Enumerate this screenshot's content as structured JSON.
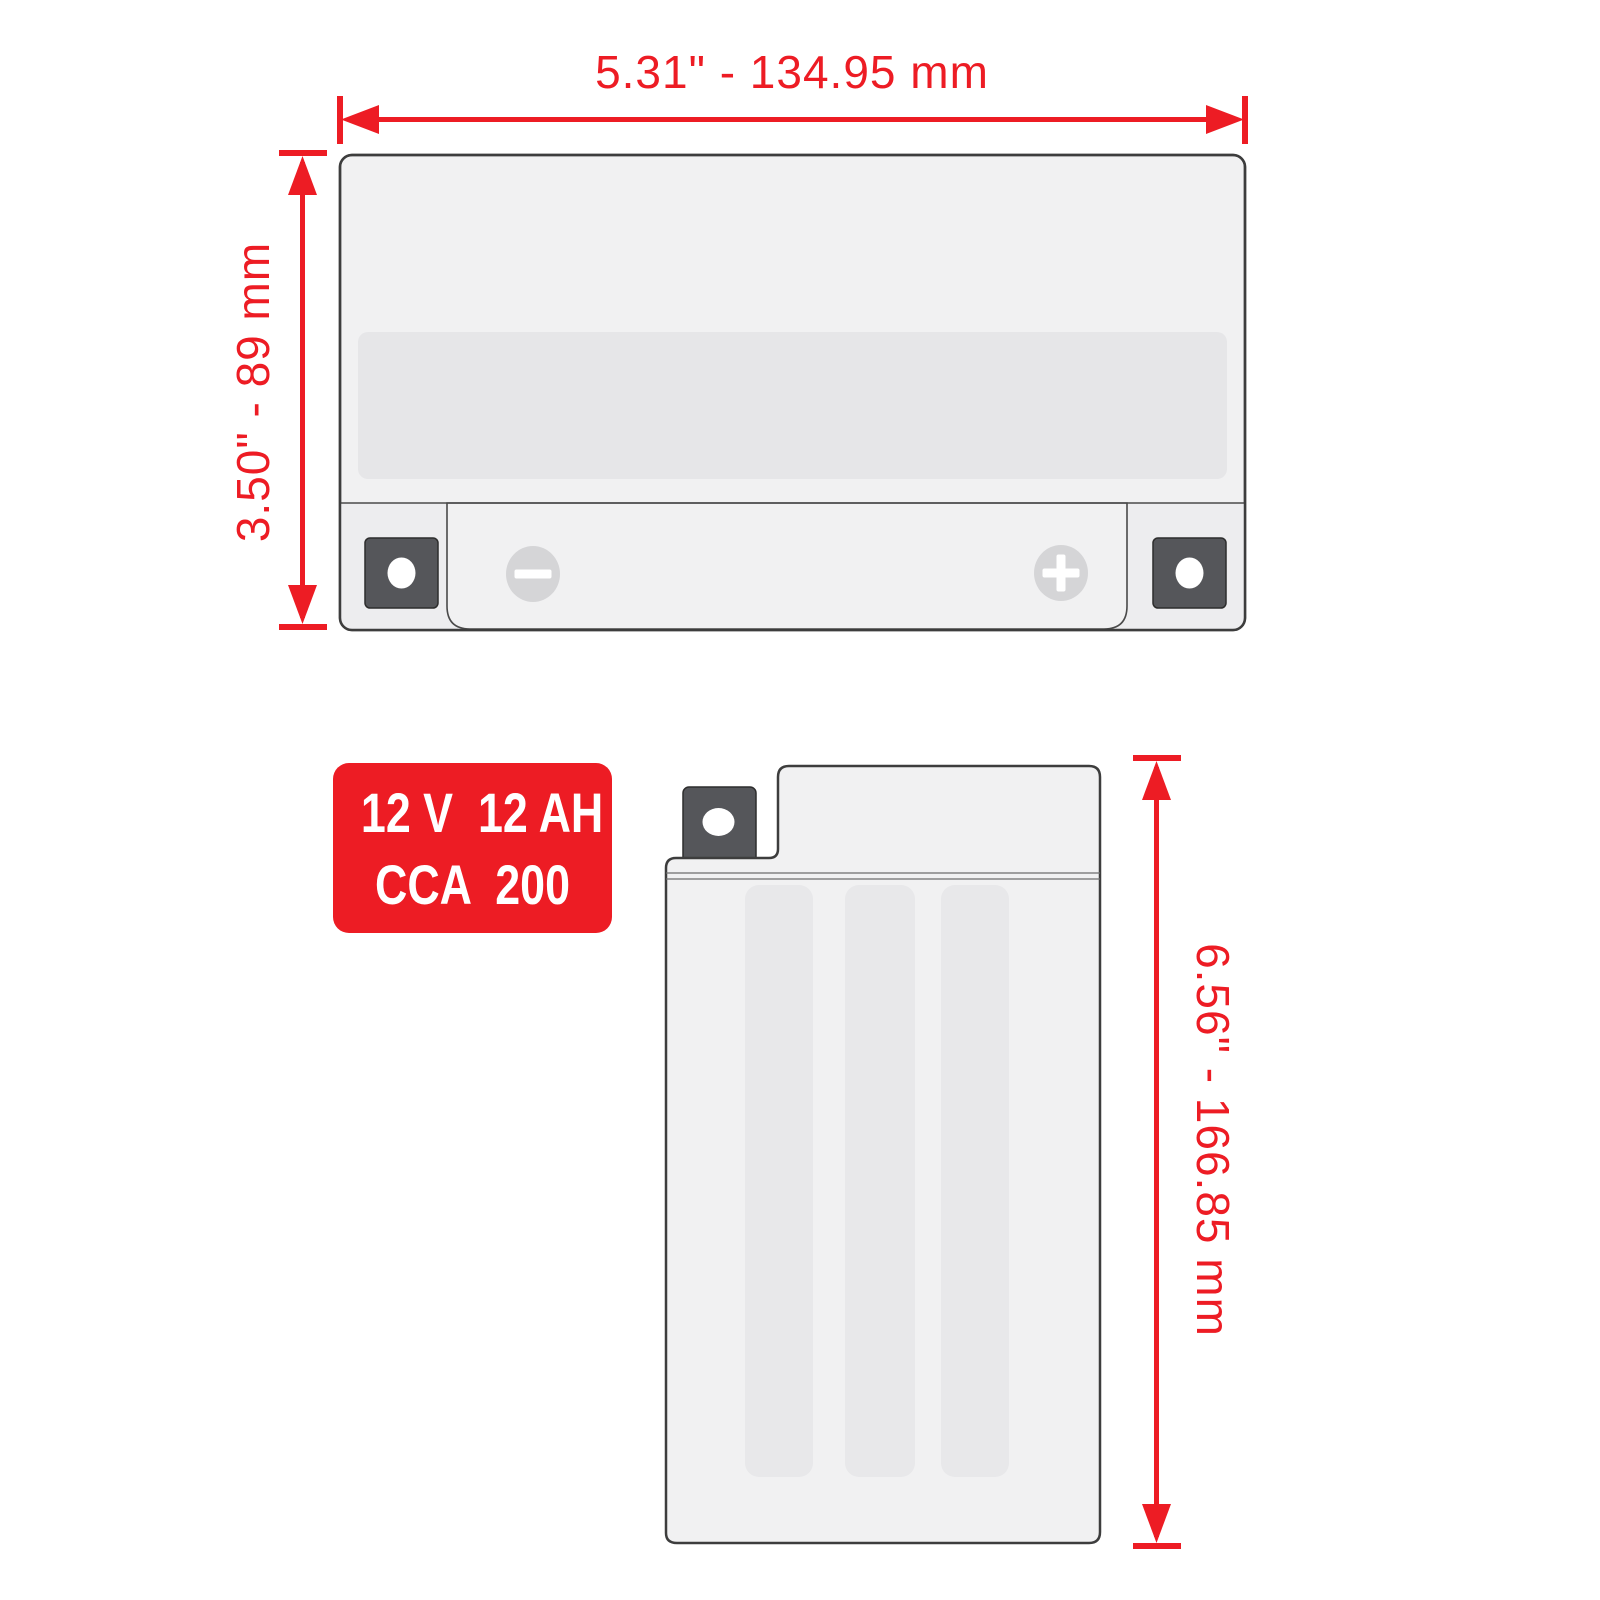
{
  "diagram_title": "battery-dimensions-diagram",
  "dimensions": {
    "width": {
      "label": "5.31\" - 134.95 mm"
    },
    "height": {
      "label": "3.50\" - 89 mm"
    },
    "side_height": {
      "label": "6.56\" - 166.85 mm"
    }
  },
  "badge": {
    "line1": "12 V  12 AH",
    "line2": "CCA  200"
  },
  "colors": {
    "dimension_red": "#ed1c24",
    "badge_red": "#ed1c24",
    "badge_text": "#ffffff",
    "battery_body": "#f1f1f2",
    "label_band": "#e6e6e8",
    "plate_stripe": "#e8e8ea",
    "base_strip": "#ededef",
    "terminal_block": "#55565a",
    "terminal_pad": "#d5d5d7",
    "outline": "#3d3d3d"
  },
  "icons": {
    "negative_terminal": "minus-icon",
    "positive_terminal": "plus-icon",
    "bolt_hole": "bolt-hole-icon"
  }
}
